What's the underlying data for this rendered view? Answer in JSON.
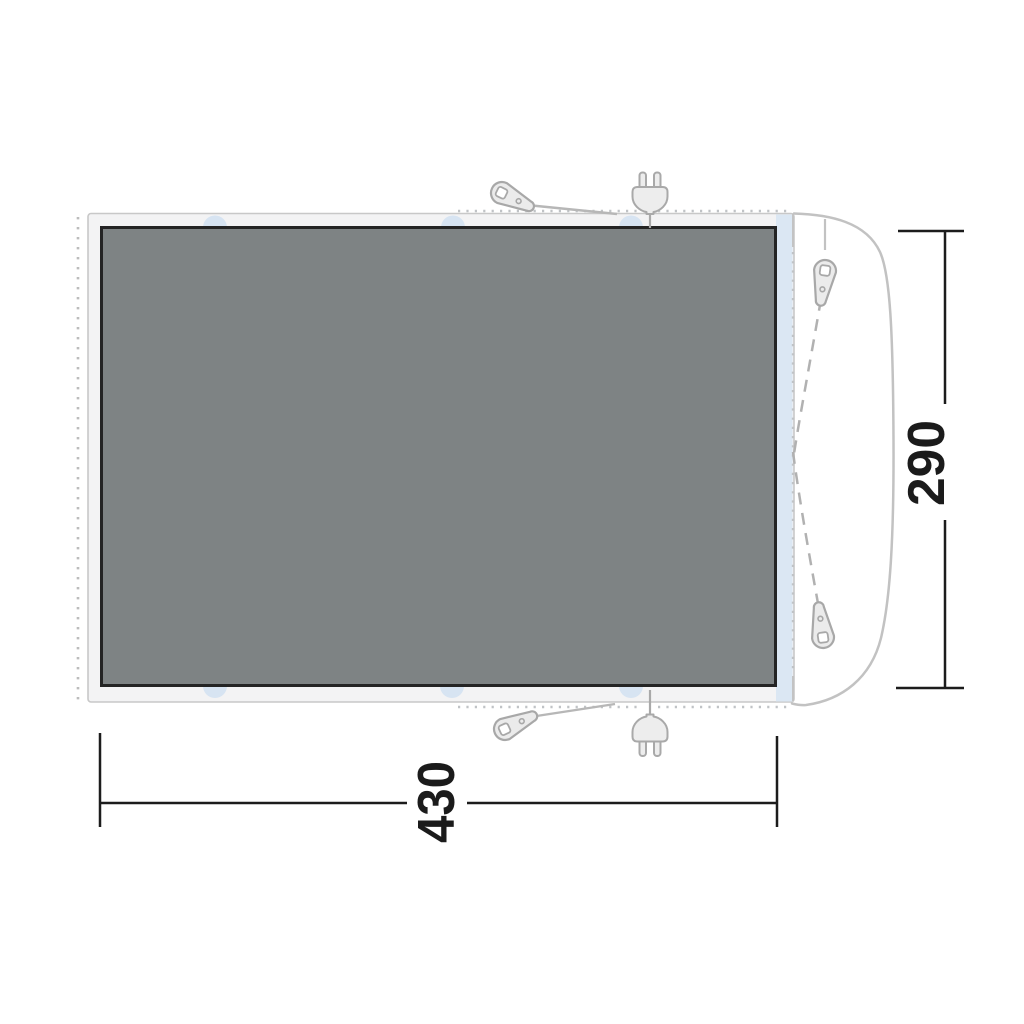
{
  "diagram": {
    "type": "awning-footprint-floor-plan",
    "dimensions": {
      "width": "430",
      "height": "290"
    },
    "colors": {
      "groundsheet_fill": "#7e8384",
      "groundsheet_border": "#242424",
      "canvas_band_fill": "#f3f3f4",
      "canvas_band_border": "#c8c8c8",
      "connection_panel_fill": "#dbe7f3",
      "attachment_tab_fill": "#d7e4f2",
      "outline_gray": "#c2c2c2",
      "guy_line_gray": "#b7b7b7",
      "dimension_black": "#1c1c1c"
    },
    "icons": [
      {
        "name": "tent-peg-icon",
        "count": 4
      },
      {
        "name": "power-plug-icon",
        "count": 2
      }
    ]
  }
}
